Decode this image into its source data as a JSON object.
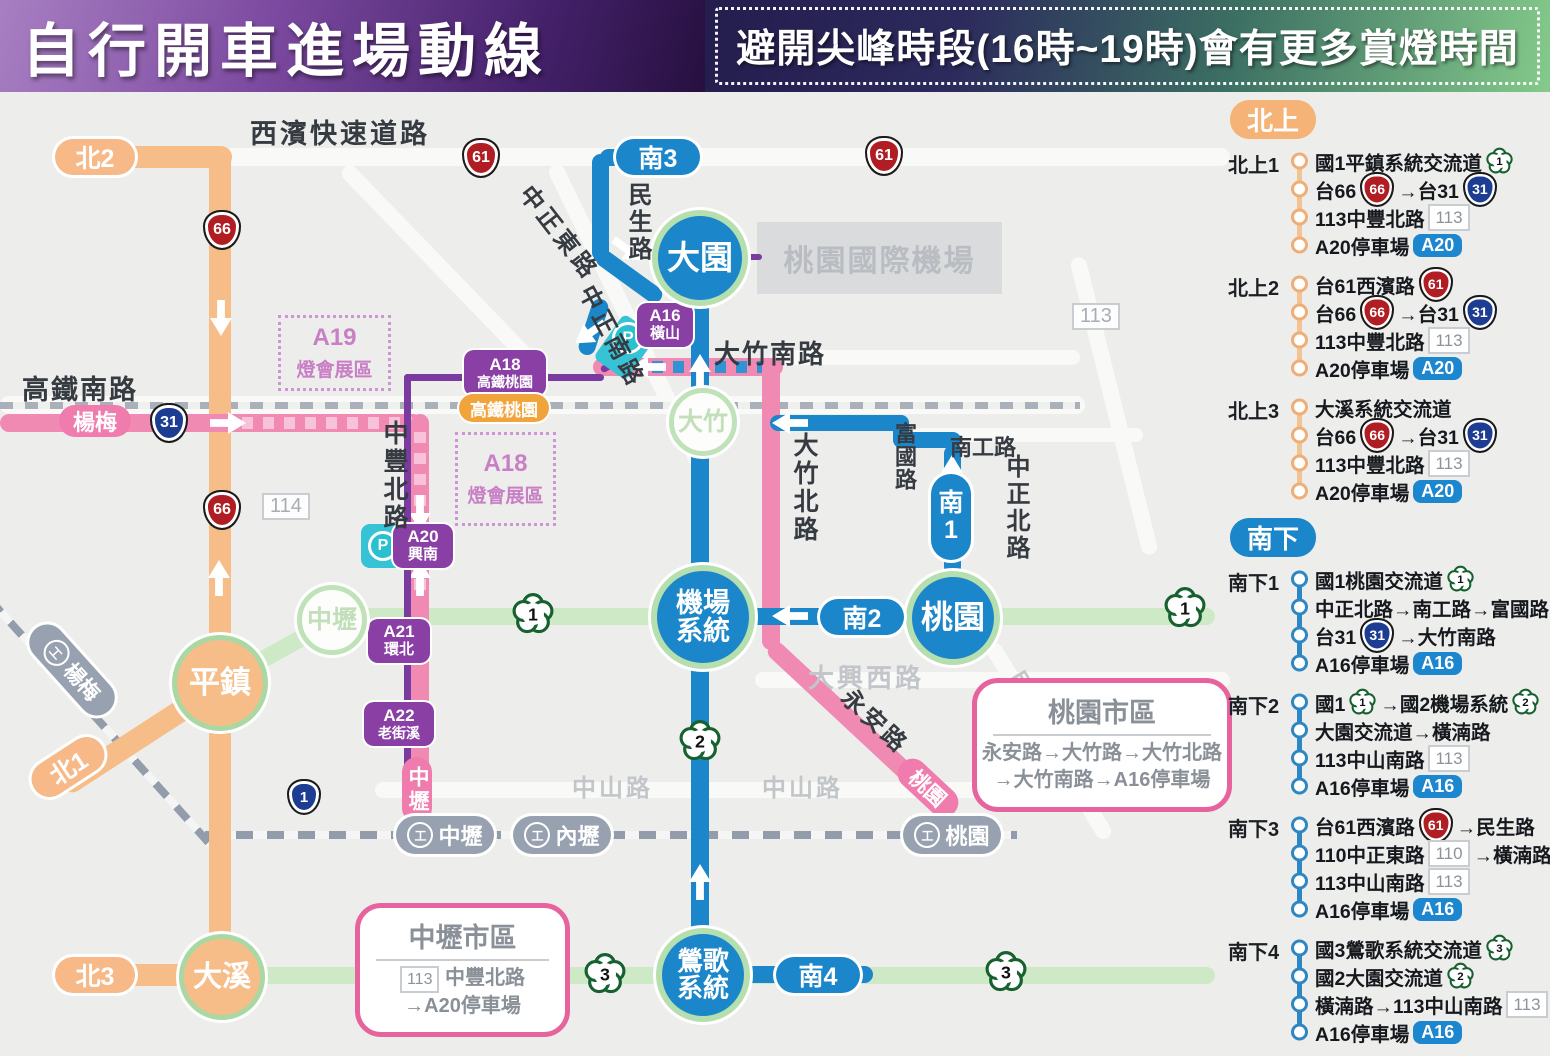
{
  "header": {
    "title": "自行開車進場動線",
    "notice": "避開尖峰時段(16時~19時)會有更多賞燈時間"
  },
  "map": {
    "road_labels": {
      "xibin": "西濱快速道路",
      "gaotie_nan": "高鐵南路",
      "minsheng": "民生路",
      "zhongzheng_dong": "中正東路",
      "zhongzheng_nan": "中正南路",
      "dazhu_nan": "大竹南路",
      "fuguo": "富國路",
      "nangong": "南工路",
      "zhongzheng_bei": "中正北路",
      "dazhu_bei": "大竹北路",
      "zhongfeng_bei": "中豐北路",
      "daxing_xi": "大興西路",
      "zhongshan_a": "中山路",
      "zhongshan_b": "中山路",
      "minzu": "民族路",
      "yongan": "永安路",
      "airport": "桃園國際機場",
      "box113": "113",
      "box114": "114"
    },
    "shields": {
      "s61a": "61",
      "s61b": "61",
      "s66a": "66",
      "s66b": "66",
      "s31": "31",
      "s1": "1"
    },
    "plums": {
      "p1a": "1",
      "p1b": "1",
      "p2": "2",
      "p3a": "3",
      "p3b": "3"
    },
    "route_pills": {
      "bei1": "北1",
      "bei2": "北2",
      "bei3": "北3",
      "nan1": "南1",
      "nan2": "南2",
      "nan3": "南3",
      "nan4": "南4"
    },
    "pink_pills": {
      "yangmei": "楊梅",
      "zhongli": "中壢",
      "taoyuan": "桃園"
    },
    "nodes": {
      "dayuan": "大園",
      "dazhu": "大竹",
      "jichang1": "機場",
      "jichang2": "系統",
      "taoyuan": "桃園",
      "zhongli": "中壢",
      "pingzhen": "平鎮",
      "daxi": "大溪",
      "yingge1": "鶯歌",
      "yingge2": "系統"
    },
    "mrt": {
      "a16_1": "A16",
      "a16_2": "橫山",
      "a18_1": "A18",
      "a18_2": "高鐵桃園",
      "a20_1": "A20",
      "a20_2": "興南",
      "a21_1": "A21",
      "a21_2": "環北",
      "a22_1": "A22",
      "a22_2": "老街溪"
    },
    "hsr_station": "高鐵桃園",
    "tra": {
      "yangmei": "楊梅",
      "zhongli": "中壢",
      "neili": "內壢",
      "taoyuan": "桃園"
    },
    "parking_p": "P",
    "expo": {
      "a19_1": "A19",
      "a19_2": "燈會展區",
      "a18_1": "A18",
      "a18_2": "燈會展區"
    },
    "city_boxes": {
      "taoyuan": {
        "title": "桃園市區",
        "line1": "永安路→大竹路→大竹北路",
        "line2": "→大竹南路→A16停車場"
      },
      "zhongli": {
        "title": "中壢市區",
        "badge": "113",
        "line1": "中豐北路",
        "line2": "→A20停車場"
      }
    }
  },
  "sidebar": {
    "sections": [
      {
        "pill": "北上",
        "style": "north",
        "routes": [
          {
            "label": "北上1",
            "steps": [
              [
                {
                  "t": "text",
                  "v": "國1平鎮系統交流道 "
                },
                {
                  "t": "plum",
                  "v": "1"
                }
              ],
              [
                {
                  "t": "text",
                  "v": "台66 "
                },
                {
                  "t": "red",
                  "v": "66"
                },
                {
                  "t": "text",
                  "v": "→台31 "
                },
                {
                  "t": "navy",
                  "v": "31"
                }
              ],
              [
                {
                  "t": "text",
                  "v": "113中豐北路 "
                },
                {
                  "t": "box",
                  "v": "113"
                }
              ],
              [
                {
                  "t": "text",
                  "v": "A20停車場 "
                },
                {
                  "t": "a",
                  "v": "A20"
                }
              ]
            ]
          },
          {
            "label": "北上2",
            "steps": [
              [
                {
                  "t": "text",
                  "v": "台61西濱路 "
                },
                {
                  "t": "red",
                  "v": "61"
                }
              ],
              [
                {
                  "t": "text",
                  "v": "台66 "
                },
                {
                  "t": "red",
                  "v": "66"
                },
                {
                  "t": "text",
                  "v": "→台31 "
                },
                {
                  "t": "navy",
                  "v": "31"
                }
              ],
              [
                {
                  "t": "text",
                  "v": "113中豐北路 "
                },
                {
                  "t": "box",
                  "v": "113"
                }
              ],
              [
                {
                  "t": "text",
                  "v": "A20停車場 "
                },
                {
                  "t": "a",
                  "v": "A20"
                }
              ]
            ]
          },
          {
            "label": "北上3",
            "steps": [
              [
                {
                  "t": "text",
                  "v": "大溪系統交流道"
                }
              ],
              [
                {
                  "t": "text",
                  "v": "台66 "
                },
                {
                  "t": "red",
                  "v": "66"
                },
                {
                  "t": "text",
                  "v": "→台31 "
                },
                {
                  "t": "navy",
                  "v": "31"
                }
              ],
              [
                {
                  "t": "text",
                  "v": "113中豐北路 "
                },
                {
                  "t": "box",
                  "v": "113"
                }
              ],
              [
                {
                  "t": "text",
                  "v": "A20停車場 "
                },
                {
                  "t": "a",
                  "v": "A20"
                }
              ]
            ]
          }
        ]
      },
      {
        "pill": "南下",
        "style": "south",
        "routes": [
          {
            "label": "南下1",
            "steps": [
              [
                {
                  "t": "text",
                  "v": "國1桃園交流道 "
                },
                {
                  "t": "plum",
                  "v": "1"
                }
              ],
              [
                {
                  "t": "text",
                  "v": "中正北路→南工路→富國路"
                }
              ],
              [
                {
                  "t": "text",
                  "v": "台31 "
                },
                {
                  "t": "navy",
                  "v": "31"
                },
                {
                  "t": "text",
                  "v": "→大竹南路"
                }
              ],
              [
                {
                  "t": "text",
                  "v": "A16停車場 "
                },
                {
                  "t": "a",
                  "v": "A16"
                }
              ]
            ]
          },
          {
            "label": "南下2",
            "steps": [
              [
                {
                  "t": "text",
                  "v": "國1 "
                },
                {
                  "t": "plum",
                  "v": "1"
                },
                {
                  "t": "text",
                  "v": "→國2機場系統 "
                },
                {
                  "t": "plum",
                  "v": "2"
                }
              ],
              [
                {
                  "t": "text",
                  "v": "大園交流道→橫湳路"
                }
              ],
              [
                {
                  "t": "text",
                  "v": "113中山南路 "
                },
                {
                  "t": "box",
                  "v": "113"
                }
              ],
              [
                {
                  "t": "text",
                  "v": "A16停車場 "
                },
                {
                  "t": "a",
                  "v": "A16"
                }
              ]
            ]
          },
          {
            "label": "南下3",
            "steps": [
              [
                {
                  "t": "text",
                  "v": "台61西濱路 "
                },
                {
                  "t": "red",
                  "v": "61"
                },
                {
                  "t": "text",
                  "v": "→民生路"
                }
              ],
              [
                {
                  "t": "text",
                  "v": "110中正東路 "
                },
                {
                  "t": "box",
                  "v": "110"
                },
                {
                  "t": "text",
                  "v": "→橫湳路"
                }
              ],
              [
                {
                  "t": "text",
                  "v": "113中山南路 "
                },
                {
                  "t": "box",
                  "v": "113"
                }
              ],
              [
                {
                  "t": "text",
                  "v": "A16停車場 "
                },
                {
                  "t": "a",
                  "v": "A16"
                }
              ]
            ]
          },
          {
            "label": "南下4",
            "steps": [
              [
                {
                  "t": "text",
                  "v": "國3鶯歌系統交流道 "
                },
                {
                  "t": "plum",
                  "v": "3"
                }
              ],
              [
                {
                  "t": "text",
                  "v": "國2大園交流道 "
                },
                {
                  "t": "plum",
                  "v": "2"
                }
              ],
              [
                {
                  "t": "text",
                  "v": "橫湳路→113中山南路 "
                },
                {
                  "t": "box",
                  "v": "113"
                }
              ],
              [
                {
                  "t": "text",
                  "v": "A16停車場 "
                },
                {
                  "t": "a",
                  "v": "A16"
                }
              ]
            ]
          }
        ]
      }
    ]
  }
}
